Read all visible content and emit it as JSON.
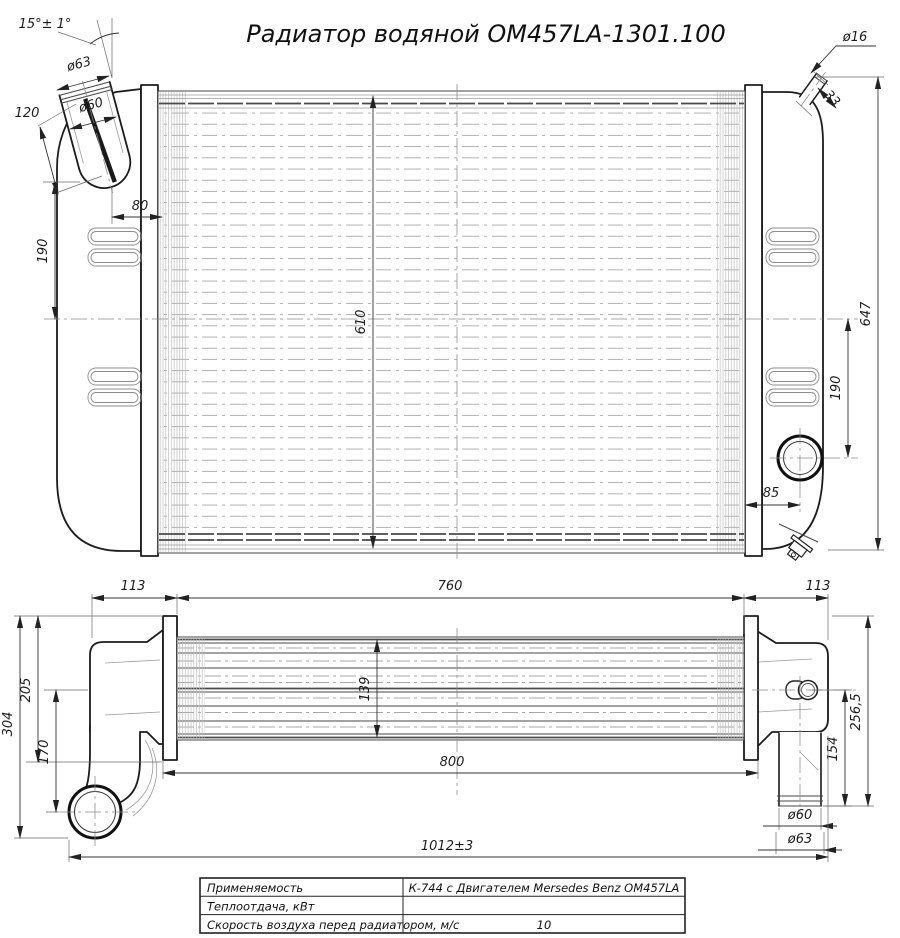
{
  "title": "Радиатор водяной ОМ457LA-1301.100",
  "front_view": {
    "dims": {
      "neck_angle": "15°± 1°",
      "neck_outer_dia": "ø63",
      "neck_inner_dia": "ø60",
      "neck_length": "120",
      "neck_offset": "80",
      "upper_span": "190",
      "core_height": "610",
      "steam_pipe_dia": "ø16",
      "steam_pipe_length": "33",
      "tank_height": "647",
      "lower_span": "190",
      "outlet_offset": "85"
    }
  },
  "bottom_view": {
    "dims": {
      "left_tank_depth": "113",
      "core_width": "760",
      "right_tank_depth": "113",
      "total_height": "304",
      "tank_height": "205",
      "pipe_drop": "170",
      "core_depth": "139",
      "frame_width": "800",
      "outlet_drop": "154",
      "right_height": "256,5",
      "outlet_inner_dia": "ø60",
      "outlet_outer_dia": "ø63",
      "overall_length": "1012±3"
    }
  },
  "spec_table": {
    "rows": [
      {
        "label": "Применяемость",
        "value": "К-744 с Двигателем Mersedes Benz ОМ457LA"
      },
      {
        "label": "Теплоотдача, кВт",
        "value": ""
      },
      {
        "label": "Скорость воздуха перед радиатором, м/с",
        "value": "10"
      }
    ]
  },
  "colors": {
    "line": "#1c1c1c",
    "dimension": "#333333",
    "light_detail": "#9a9a9a",
    "background": "#ffffff"
  }
}
